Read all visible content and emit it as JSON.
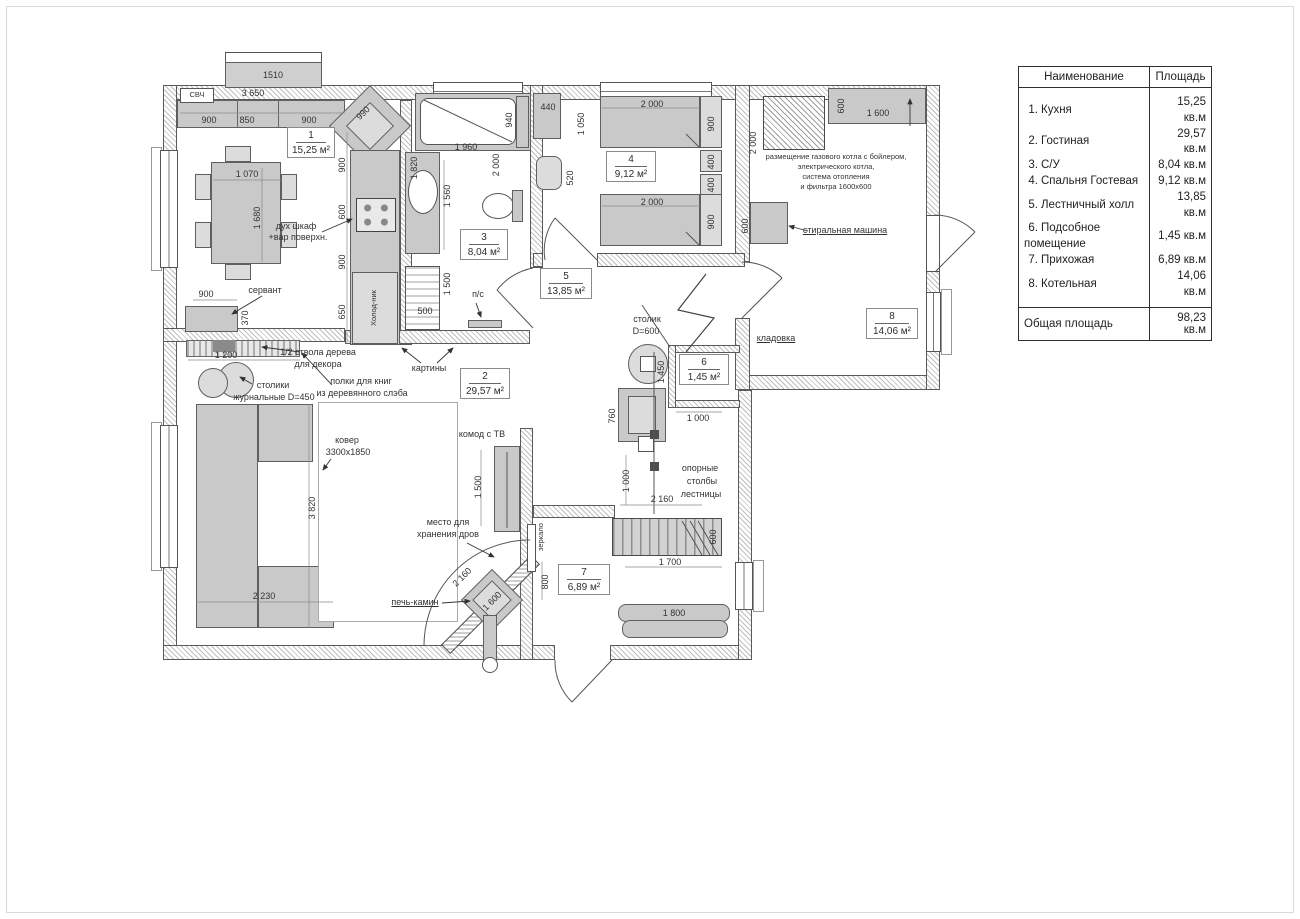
{
  "legend": {
    "col_name": "Наименование",
    "col_area": "Площадь",
    "rows": [
      {
        "num": "1.",
        "name": "Кухня",
        "area": "15,25 кв.м"
      },
      {
        "num": "2.",
        "name": "Гостиная",
        "area": "29,57 кв.м"
      },
      {
        "num": "3.",
        "name": "С/У",
        "area": "8,04 кв.м"
      },
      {
        "num": "4.",
        "name": "Спальня Гостевая",
        "area": "9,12 кв.м"
      },
      {
        "num": "5.",
        "name": "Лестничный холл",
        "area": "13,85 кв.м"
      },
      {
        "num": "6.",
        "name": "Подсобное помещение",
        "area": "1,45 кв.м"
      },
      {
        "num": "7.",
        "name": "Прихожая",
        "area": "6,89 кв.м"
      },
      {
        "num": "8.",
        "name": "Котельная",
        "area": "14,06 кв.м"
      }
    ],
    "total_label": "Общая площадь",
    "total_area": "98,23 кв.м"
  },
  "rooms": [
    {
      "num": "1",
      "area": "15,25 м²"
    },
    {
      "num": "2",
      "area": "29,57 м²"
    },
    {
      "num": "3",
      "area": "8,04 м²"
    },
    {
      "num": "4",
      "area": "9,12 м²"
    },
    {
      "num": "5",
      "area": "13,85 м²"
    },
    {
      "num": "6",
      "area": "1,45 м²"
    },
    {
      "num": "7",
      "area": "6,89 м²"
    },
    {
      "num": "8",
      "area": "14,06 м²"
    }
  ],
  "dims": {
    "porch": "1510",
    "ktop_total": "3 650",
    "ktop1": "900",
    "ktop2": "850",
    "ktop3": "900",
    "kcorner": "990",
    "table_w": "1 070",
    "table_h": "1 680",
    "kr1": "900",
    "kr2": "600",
    "kr3": "900",
    "kr4": "650",
    "serv_w": "900",
    "serv_d": "370",
    "log_w": "1 200",
    "tub_w": "1 960",
    "tub_h": "940",
    "b1820": "1 820",
    "b1560": "1 560",
    "b2000": "2 000",
    "b1500": "1 500",
    "b500": "500",
    "c440": "440",
    "c1050": "1 050",
    "c520": "520",
    "bed1": "2 000",
    "bed1w": "900",
    "n400a": "400",
    "n400b": "400",
    "bed2": "2 000",
    "bed2w": "900",
    "blr2000": "2 000",
    "blr600": "600",
    "blr1600": "1 600",
    "wash600": "600",
    "t1450": "1 450",
    "a760": "760",
    "cl1000": "1 000",
    "st1000": "1 000",
    "st2160": "2 160",
    "sofa_w": "2 230",
    "sofa_h": "3 820",
    "tv1500": "1 500",
    "fp2160": "2 160",
    "fp1600": "1 600",
    "h800": "800",
    "w600": "600",
    "w1700": "1 700",
    "b1800": "1 800"
  },
  "labels": {
    "svch": "СВЧ",
    "servant": "сервант",
    "oven1": "дух шкаф",
    "oven2": "+вар поверхн.",
    "fridge": "Холод-ник",
    "log1": "1/2 ствола дерева",
    "log2": "для декора",
    "shelves1": "полки для книг",
    "shelves2": "из деревянного слэба",
    "ctables1": "столики",
    "ctables2": "журнальные D=450",
    "pictures": "картины",
    "carpet1": "ковер",
    "carpet2": "3300х1850",
    "tv": "комод с ТВ",
    "wood1": "место для",
    "wood2": "хранения дров",
    "fireplace": "печь-камин",
    "mirror": "зеркало",
    "ps": "п/с",
    "stable1": "столик",
    "stable2": "D=600",
    "posts1": "опорные",
    "posts2": "столбы",
    "posts3": "лестницы",
    "blr1": "размещение газового котла с бойлером,",
    "blr2": "электрического котла,",
    "blr3": "система отопления",
    "blr4": "и фильтра 1600х600",
    "washer": "стиральная машина",
    "kladovka": "кладовка"
  }
}
